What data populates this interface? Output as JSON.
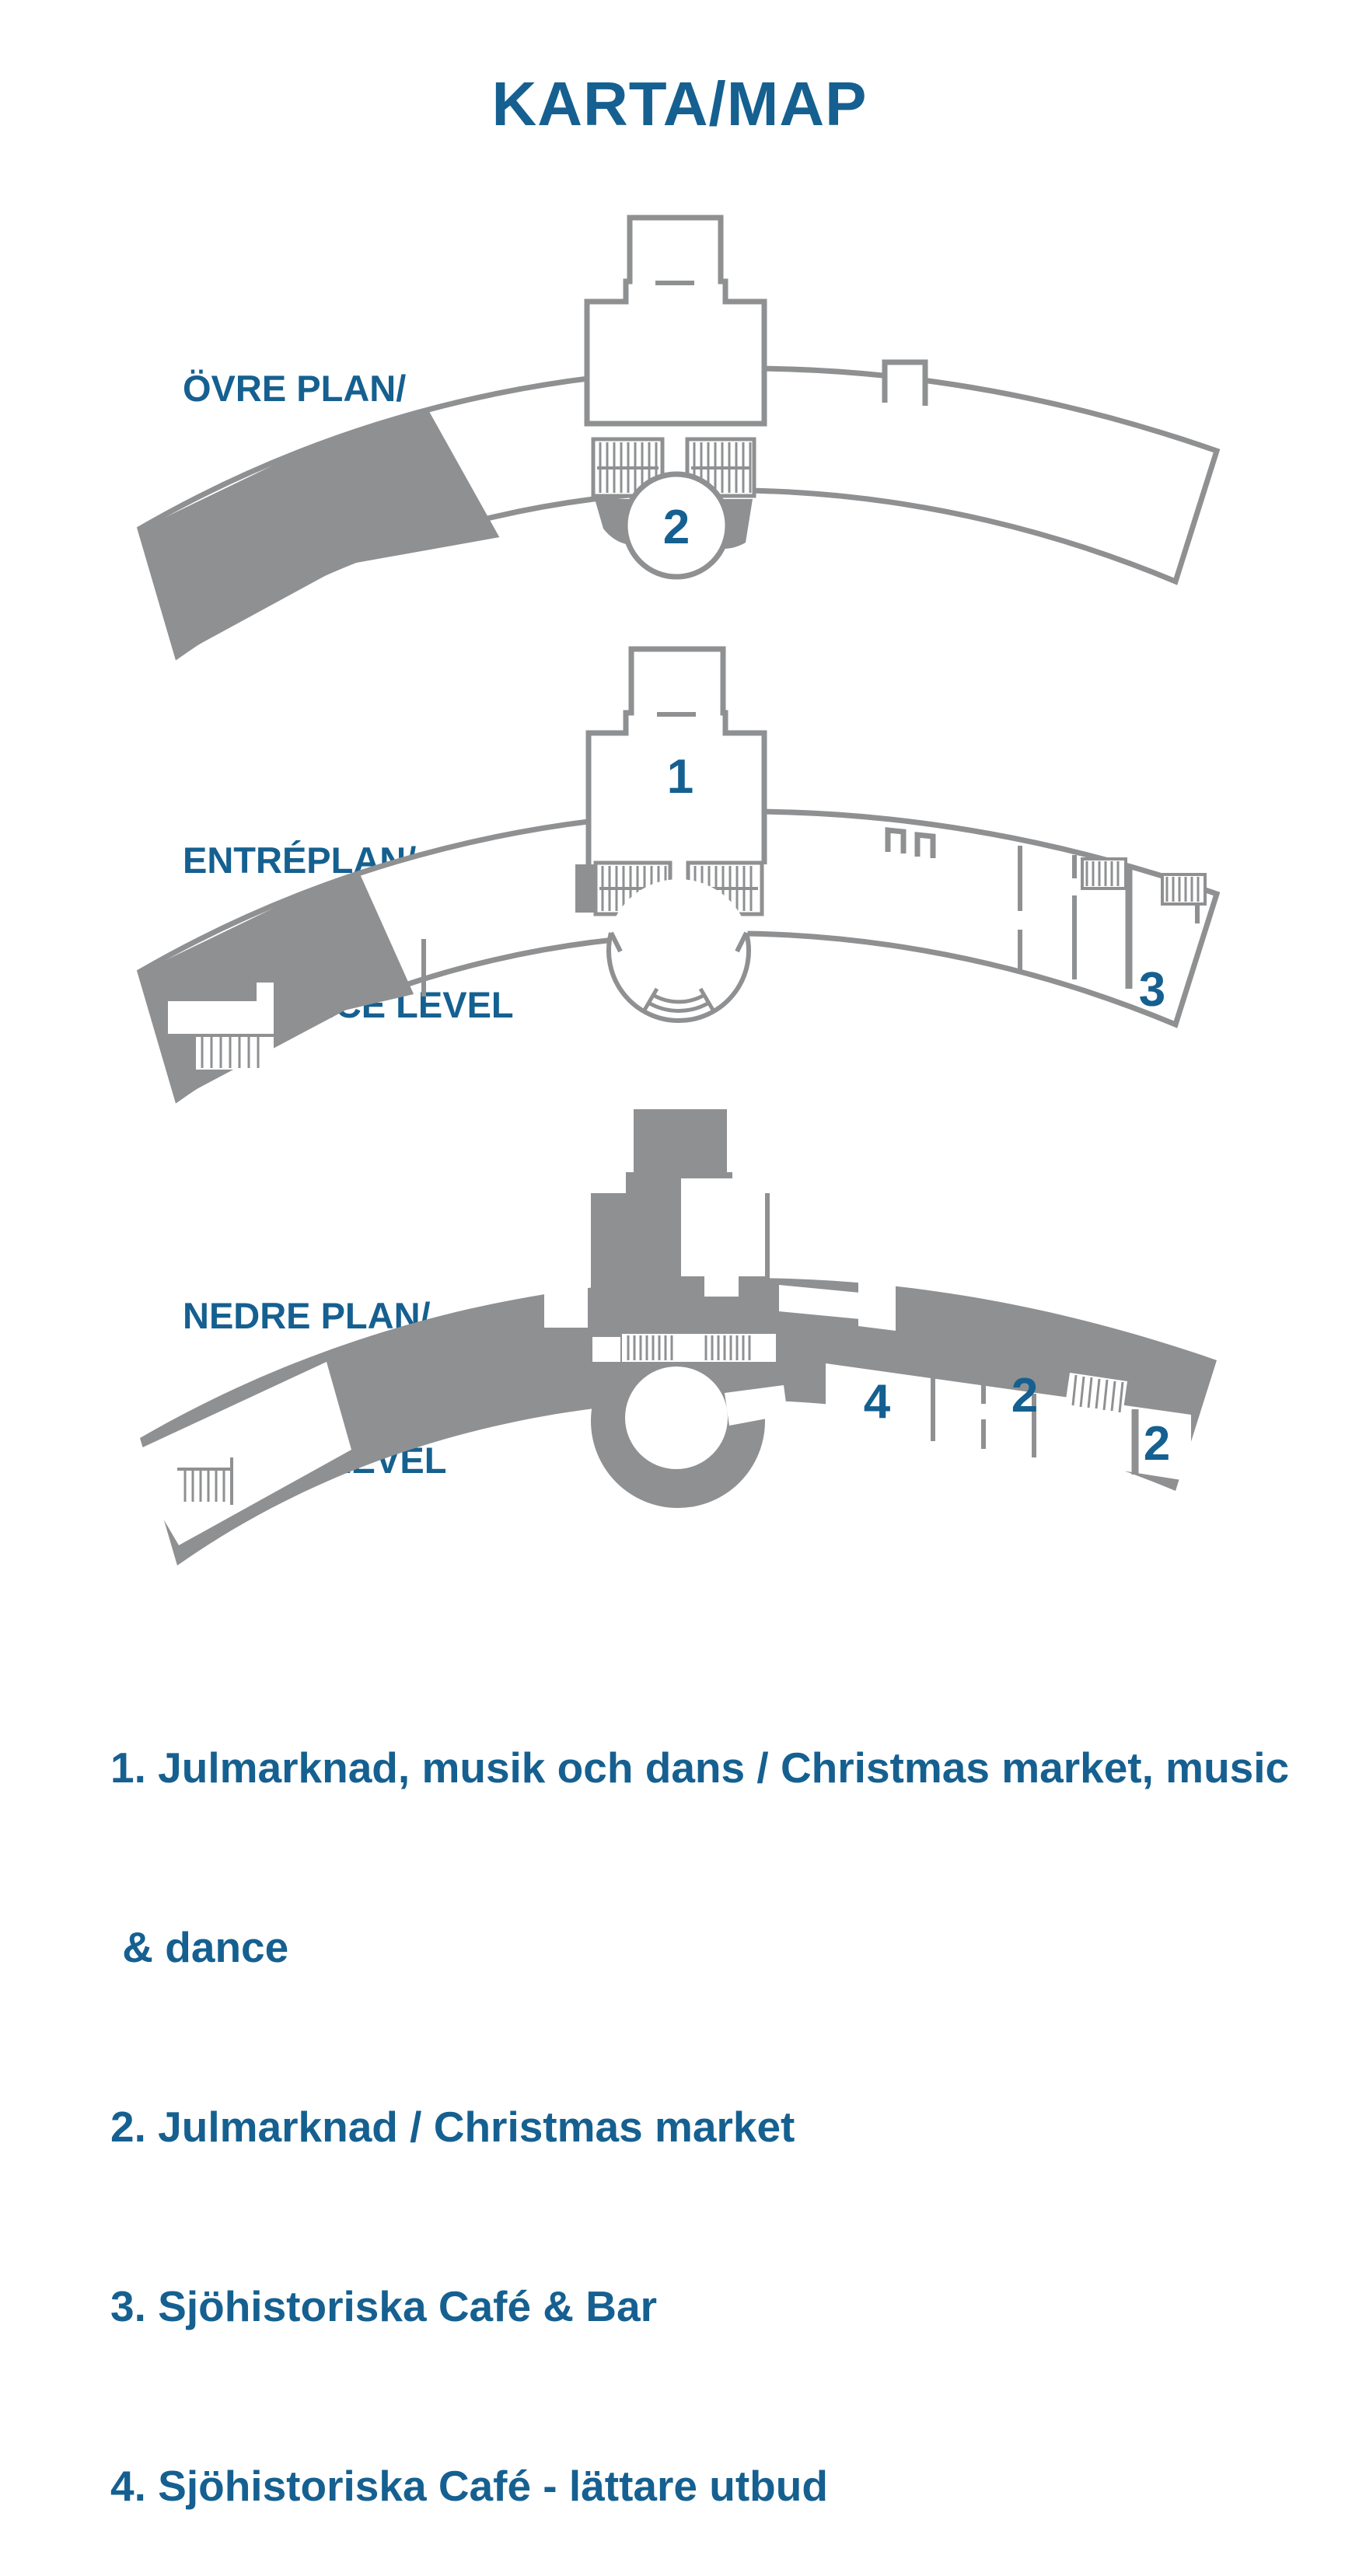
{
  "title": "KARTA/MAP",
  "colors": {
    "accent_blue": "#156090",
    "plan_gray": "#8F9092",
    "background": "#FFFFFF"
  },
  "levels": [
    {
      "id": "upper",
      "name_sv": "ÖVRE PLAN/",
      "name_en": "UPPER LEVEL",
      "markers": [
        {
          "label": "2"
        }
      ]
    },
    {
      "id": "entrance",
      "name_sv": "ENTRÉPLAN/",
      "name_en": "ENTRANCE LEVEL",
      "markers": [
        {
          "label": "1"
        },
        {
          "label": "3"
        }
      ]
    },
    {
      "id": "lower",
      "name_sv": "NEDRE PLAN/",
      "name_en": "LOWER LEVEL",
      "markers": [
        {
          "label": "4"
        },
        {
          "label": "2"
        },
        {
          "label": "2"
        }
      ]
    }
  ],
  "legend": {
    "lines": [
      "1. Julmarknad, musik och dans / Christmas market, music",
      " & dance",
      "2. Julmarknad / Christmas market",
      "3. Sjöhistoriska Café & Bar",
      "4. Sjöhistoriska Café - lättare utbud"
    ]
  }
}
